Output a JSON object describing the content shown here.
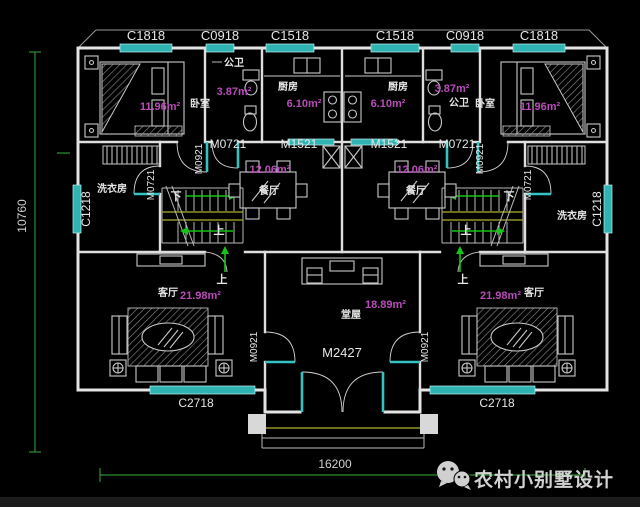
{
  "dimensions": {
    "width_mm": "16200",
    "height_mm": "10760"
  },
  "windows": {
    "top": [
      "C1818",
      "C0918",
      "C1518",
      "C1518",
      "C0918",
      "C1818"
    ],
    "side_label": "C1218",
    "bottom_label": "C2718"
  },
  "doors": {
    "main_entry": "M2427",
    "kitchen": "M1521",
    "bath": "M0721",
    "laundry": "M0721",
    "entry": "M0921",
    "living": "M0921"
  },
  "rooms": {
    "bedroom": {
      "name": "卧室",
      "area": "11.96m²"
    },
    "bathroom": {
      "name": "公卫",
      "area": "3.87m²"
    },
    "kitchen": {
      "name": "厨房",
      "area": "6.10m²"
    },
    "dining": {
      "name": "餐厅",
      "area": "12.06m²"
    },
    "laundry": {
      "name": "洗衣房"
    },
    "living": {
      "name": "客厅",
      "area": "21.98m²"
    },
    "hall": {
      "name": "堂屋",
      "area": "18.89m²"
    }
  },
  "stairs": {
    "up": "上",
    "down": "下"
  },
  "watermark": {
    "brand": "农村小别墅设计"
  },
  "colors": {
    "window": "#2fb3b3",
    "area_text": "#b84cb8",
    "dimension": "#2e8f2e",
    "arrow": "#16c316",
    "rail": "#93932e",
    "wall": "#e4e4e4"
  }
}
